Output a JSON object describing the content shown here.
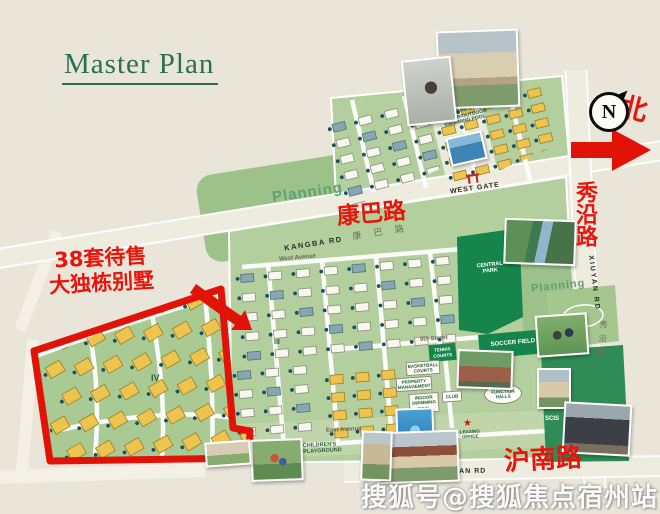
{
  "title": "Master Plan",
  "annotation": {
    "line1": "38套待售",
    "line2": "大独栋别墅"
  },
  "compass": {
    "letter": "N",
    "north_char": "北"
  },
  "roads": {
    "kangba_cn_red": "康巴路",
    "kangba_cn_road": "康 巴 路",
    "kangba_en": "KANGBA RD",
    "west_gate": "WEST GATE",
    "xiuyan_cn_red": "秀沿路",
    "xiuyan_en": "XIUYAN RD",
    "xiuyan_cn_road": "秀沿路",
    "hunan_cn_red": "沪南路",
    "hunan_en": "HUNAN RD",
    "east_gate": "EAST GATE",
    "west_avenue": "West Avenue",
    "east_avenue": "East Avenue",
    "ninth_street": "9th Street"
  },
  "areas": {
    "planning_left": "Planning",
    "planning_right": "Planning",
    "central_park": "CENTRAL PARK",
    "soccer_field": "SOCCER FIELD",
    "tennis_courts": "TENNIS COURTS",
    "scis": "SCIS",
    "skate_park": "SKATE PARK",
    "club_pool": "CLUB & INDOOR/OUTDOOR SWIMMING POOL",
    "phase_iii": "III",
    "phase_iv": "IV",
    "childrens_playground": "CHILDREN'S PLAYGROUND"
  },
  "facilities": {
    "basketball": "BASKETBALL COURTS",
    "property_mgmt": "PROPERTY MANAGEMENT",
    "indoor_pool": "INDOOR SWIMMING POOL",
    "club": "CLUB",
    "function_halls": "FUNCTION HALLS",
    "leasing_office": "LEASING OFFICE"
  },
  "watermark": "搜狐号@搜狐焦点宿州站",
  "colors": {
    "accent_red": "#e8150d",
    "map_green": "#b2cf9d",
    "planning_green": "#9cc289",
    "park_green": "#15854b",
    "villa_yellow": "#ecc44f",
    "title_green": "#2c6e55",
    "background": "#e9e5d9"
  }
}
